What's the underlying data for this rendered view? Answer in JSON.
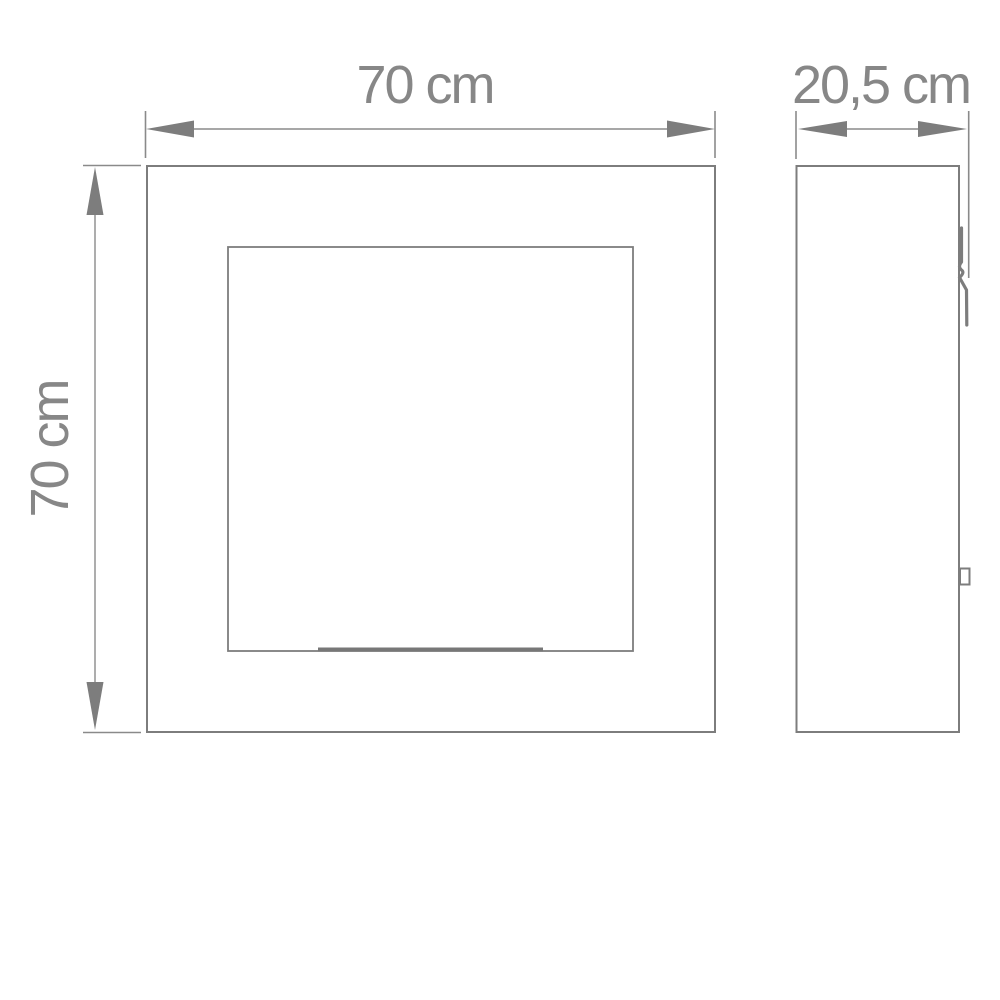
{
  "drawing": {
    "type": "technical-dimension-drawing",
    "subject": "square wall cabinet with inset door panel, front and side elevation",
    "views": {
      "front": {
        "name": "front-elevation",
        "outer_square": "70 x 70 cm",
        "features": [
          "inset door panel",
          "bottom handle groove"
        ]
      },
      "side": {
        "name": "side-elevation",
        "depth": "20,5 cm",
        "features": [
          "wall bracket hook at top rear",
          "mount plate at lower rear"
        ]
      }
    },
    "dimensions": {
      "width": "70 cm",
      "height": "70 cm",
      "depth": "20,5 cm"
    },
    "colors": {
      "outline": "#7d7d7d",
      "dimension_line": "#8a8a8a",
      "arrowhead": "#7d7d7d",
      "text": "#878787",
      "background": "#ffffff"
    }
  }
}
